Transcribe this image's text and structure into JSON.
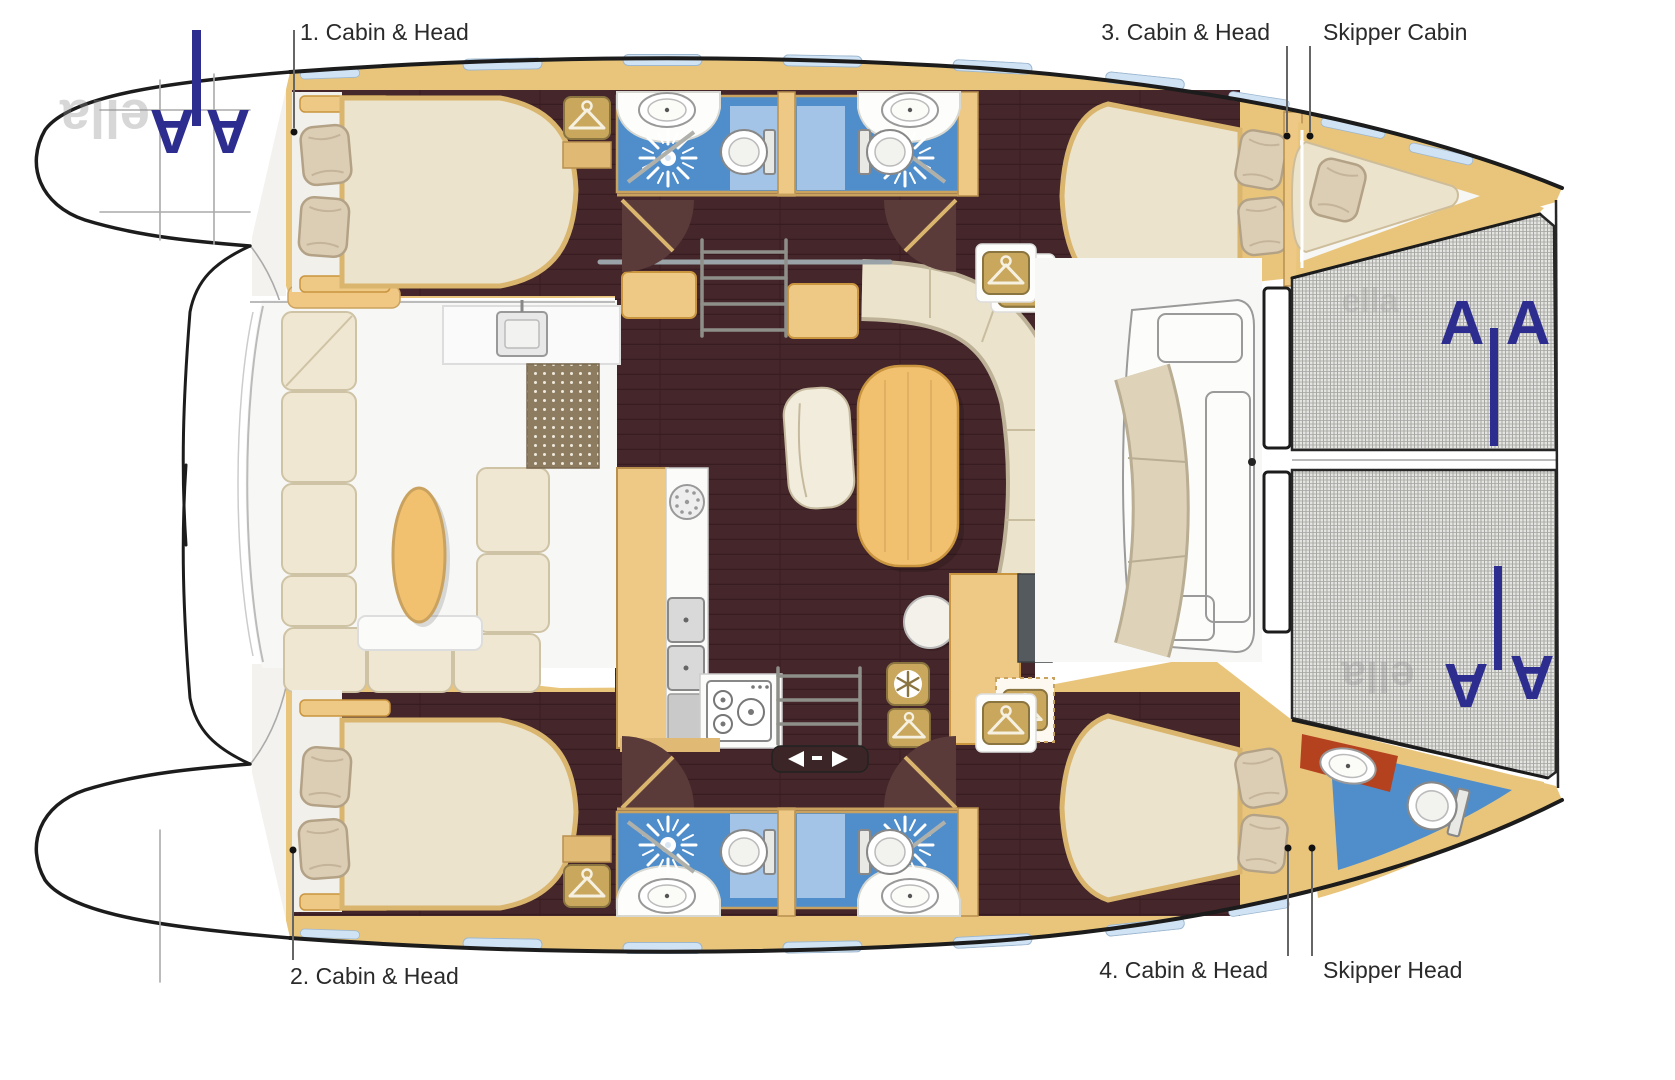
{
  "plan": {
    "title_labels": {
      "cabin1": "1. Cabin & Head",
      "cabin2": "2. Cabin & Head",
      "cabin3": "3. Cabin & Head",
      "cabin4": "4. Cabin & Head",
      "skipper_cabin": "Skipper Cabin",
      "skipper_head": "Skipper Head"
    },
    "watermark": {
      "logo_letter": "A",
      "brand_fragment": "ella"
    },
    "colors": {
      "deck_wood": "#e9c57c",
      "floor_dark_wood": "#45262a",
      "cushion_cream": "#ece3cd",
      "pillow_beige": "#dccdb5",
      "bathroom_blue": "#4f8ecb",
      "bathroom_blue_light": "#a3c4e6",
      "table_wood": "#f2c170",
      "trampoline_mesh": "#e4e4e2",
      "logo_blue": "#2d2d90",
      "label_text": "#2a2a2a",
      "skipper_counter_red": "#b5421f",
      "window_blue": "#cfe3f4"
    }
  }
}
